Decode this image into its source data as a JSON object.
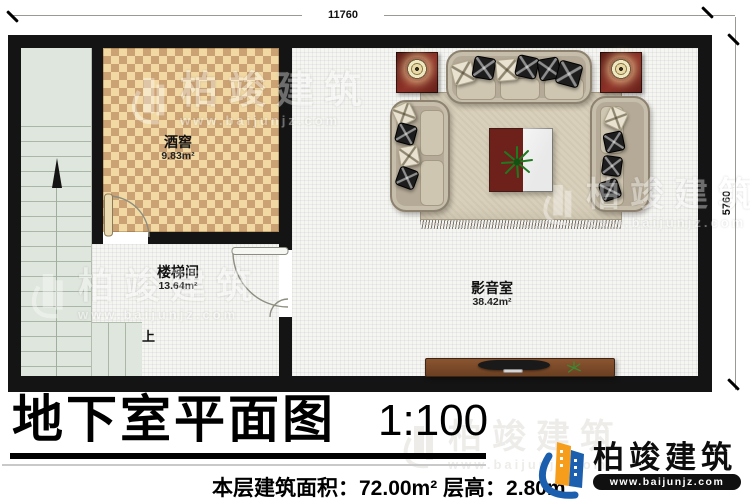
{
  "plan": {
    "dimensions": {
      "top": "11760",
      "right": "5760"
    },
    "rooms": {
      "wine_cellar": {
        "name": "酒窖",
        "area": "9.83m²"
      },
      "stairwell": {
        "name": "楼梯间",
        "area": "13.64m²"
      },
      "media_room": {
        "name": "影音室",
        "area": "38.42m²"
      }
    },
    "stairs_up_label": "上"
  },
  "title": {
    "text": "地下室平面图",
    "scale": "1:100"
  },
  "footer": {
    "stats_line": "本层建筑面积：72.00m² 层高：2.80m"
  },
  "brand": {
    "name": "柏竣建筑",
    "url": "www.baijunjz.com"
  },
  "watermark": {
    "name": "柏竣建筑",
    "url": "www.baijunjz.com"
  },
  "colors": {
    "wall": "#141414",
    "checker_light": "#f2d9a4",
    "checker_dark": "#cba273",
    "stair_floor": "#dfe6dd",
    "room_floor": "#f5f5f2",
    "accent_maroon": "#6e211b",
    "brand_blue": "#1b5fae",
    "brand_orange": "#f69d1c"
  }
}
